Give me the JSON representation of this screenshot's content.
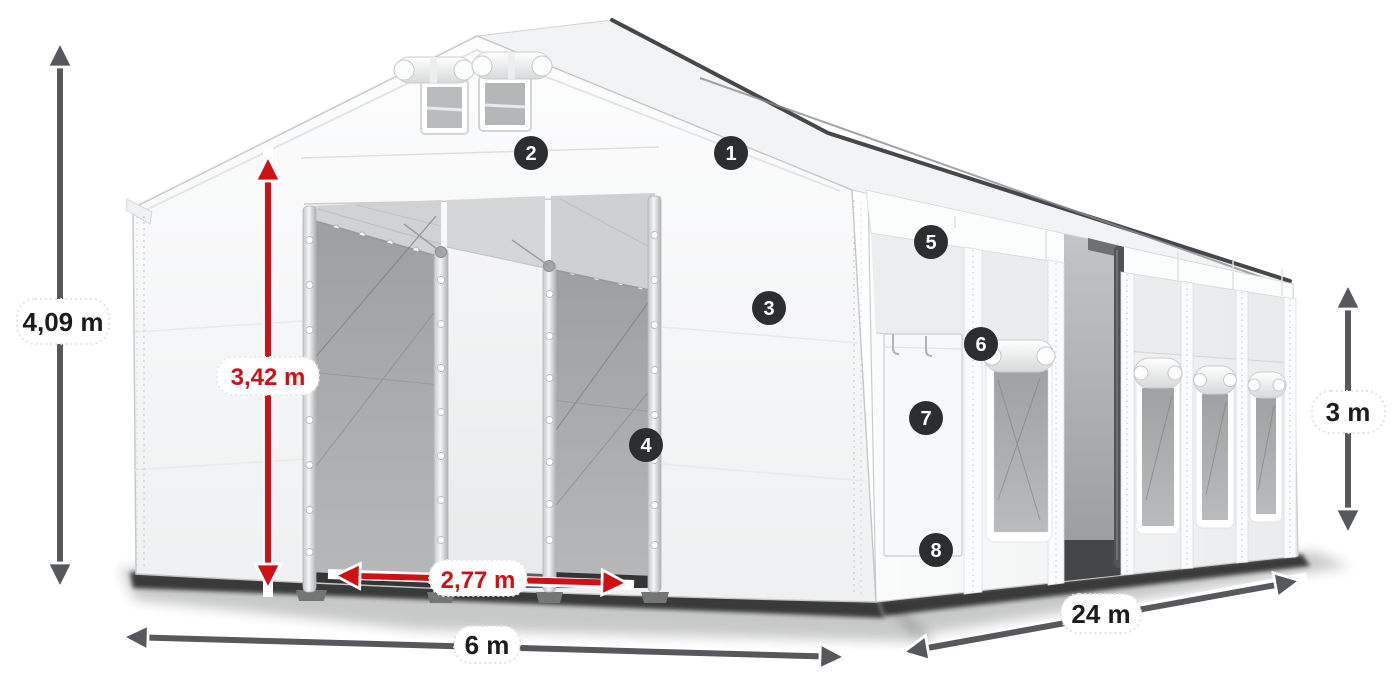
{
  "figure": {
    "title": "White storage tent with dimension callouts",
    "type": "product dimension illustration"
  },
  "dimensions": {
    "total_height": "4,09 m",
    "entrance_height": "3,42 m",
    "entrance_width": "2,77 m",
    "front_width": "6 m",
    "length": "24 m",
    "side_height": "3 m"
  },
  "callouts": [
    {
      "number": "1"
    },
    {
      "number": "2"
    },
    {
      "number": "3"
    },
    {
      "number": "4"
    },
    {
      "number": "5"
    },
    {
      "number": "6"
    },
    {
      "number": "7"
    },
    {
      "number": "8"
    }
  ],
  "colors": {
    "dimension_arrow": "#56585b",
    "red_dimension": "#cf1116",
    "callout_background": "#2c2d2f",
    "label_text": "#1c1c1e",
    "tent_fabric": "#ffffff",
    "mesh_gray": "#a8aaac"
  }
}
